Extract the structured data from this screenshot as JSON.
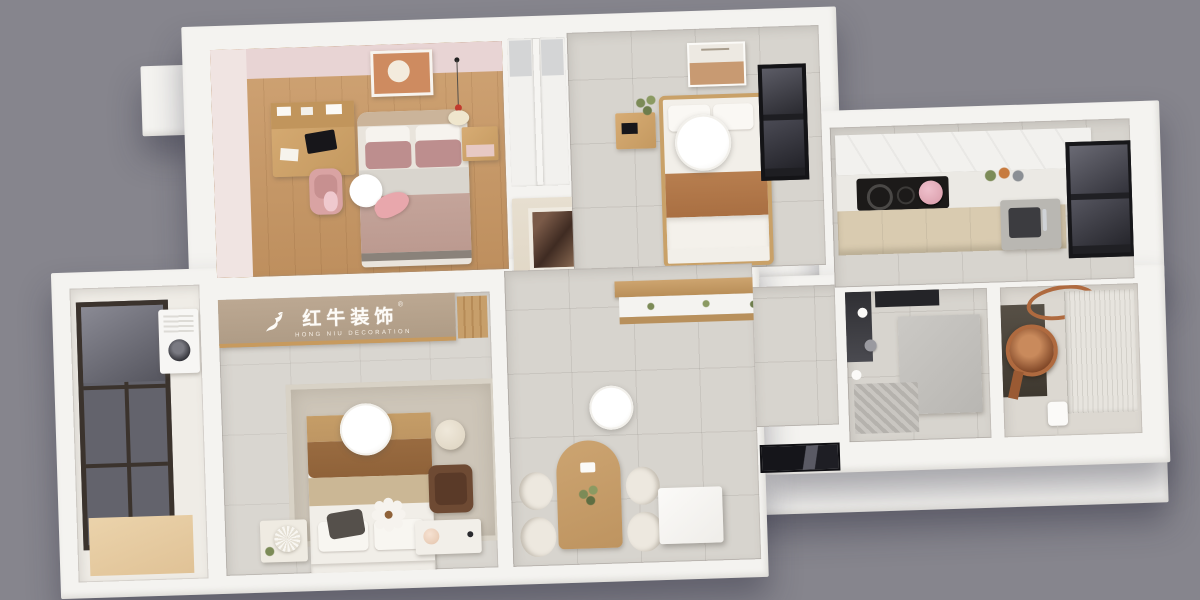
{
  "scene": {
    "type": "3d-apartment-floorplan-render",
    "view": "axonometric-top-down",
    "background_color": "#86858D",
    "wall_color": "#F4F3F0"
  },
  "watermark": {
    "brand_cn": "红牛装饰",
    "brand_en": "HONG NIU DECORATION",
    "registered": "®",
    "band_color": "#B5A28E",
    "text_color": "#FDFBF7"
  },
  "palette": {
    "wood_floor": "#C89B6C",
    "tile_floor": "#D7D4CE",
    "pink_wall": "#E8D4D4",
    "pink_textile": "#BD8E8E",
    "brown_blanket": "#B1784A",
    "master_throw": "#8F6239",
    "copper": "#AF6A3F",
    "dark_window": "#1E1E22",
    "cabinet_beige": "#D9CBB0"
  },
  "rooms": [
    {
      "id": "kids-bedroom",
      "floor": "wood",
      "items": [
        "desk-with-hutch",
        "desk-chair",
        "double-bed",
        "pink-pillows",
        "robot-vacuum",
        "whale-plush",
        "bunny-plush",
        "nightstand",
        "wall-art",
        "pendant-lamp"
      ]
    },
    {
      "id": "second-bedroom",
      "floor": "tile",
      "items": [
        "single-bed",
        "brown-blanket",
        "ceiling-lamp",
        "nightstand-with-plant",
        "wall-poster",
        "window"
      ]
    },
    {
      "id": "wardrobe-niche",
      "floor": "none",
      "items": [
        "built-in-wardrobe-left",
        "built-in-wardrobe-right"
      ]
    },
    {
      "id": "entry-hall",
      "floor": "tile",
      "items": [
        "mirror-cabinet",
        "floating-shelf-with-plants"
      ]
    },
    {
      "id": "kitchen",
      "floor": "tile",
      "items": [
        "upper-cabinets",
        "cooktop",
        "pink-kettle",
        "groceries",
        "base-cabinets",
        "sink",
        "window"
      ]
    },
    {
      "id": "shower-room",
      "floor": "tile",
      "items": [
        "glass-door",
        "partition-wall",
        "shower-head",
        "ceiling-spots",
        "drain-mat"
      ]
    },
    {
      "id": "vanity-bathroom",
      "floor": "tile",
      "items": [
        "copper-basin",
        "copper-oval-mirror",
        "dark-counter",
        "sheer-curtain",
        "light-switch"
      ]
    },
    {
      "id": "dining-area",
      "floor": "tile",
      "items": [
        "arched-dining-table",
        "dining-chair-x4",
        "table-plant",
        "remote-control",
        "pendant-lamp",
        "white-fridge-cabinet",
        "window-strip"
      ]
    },
    {
      "id": "master-bedroom",
      "floor": "tile",
      "items": [
        "logo-band",
        "wood-slats",
        "double-bed",
        "area-rug",
        "ceiling-lamp",
        "pouf",
        "leather-armchair",
        "nightstand-with-pleated-lamp",
        "nightstand-with-ball-lamp",
        "flower-pillow",
        "dark-pillow"
      ]
    },
    {
      "id": "balcony",
      "floor": "wood",
      "items": [
        "floor-to-ceiling-window",
        "washing-machine",
        "wood-mat"
      ]
    }
  ]
}
